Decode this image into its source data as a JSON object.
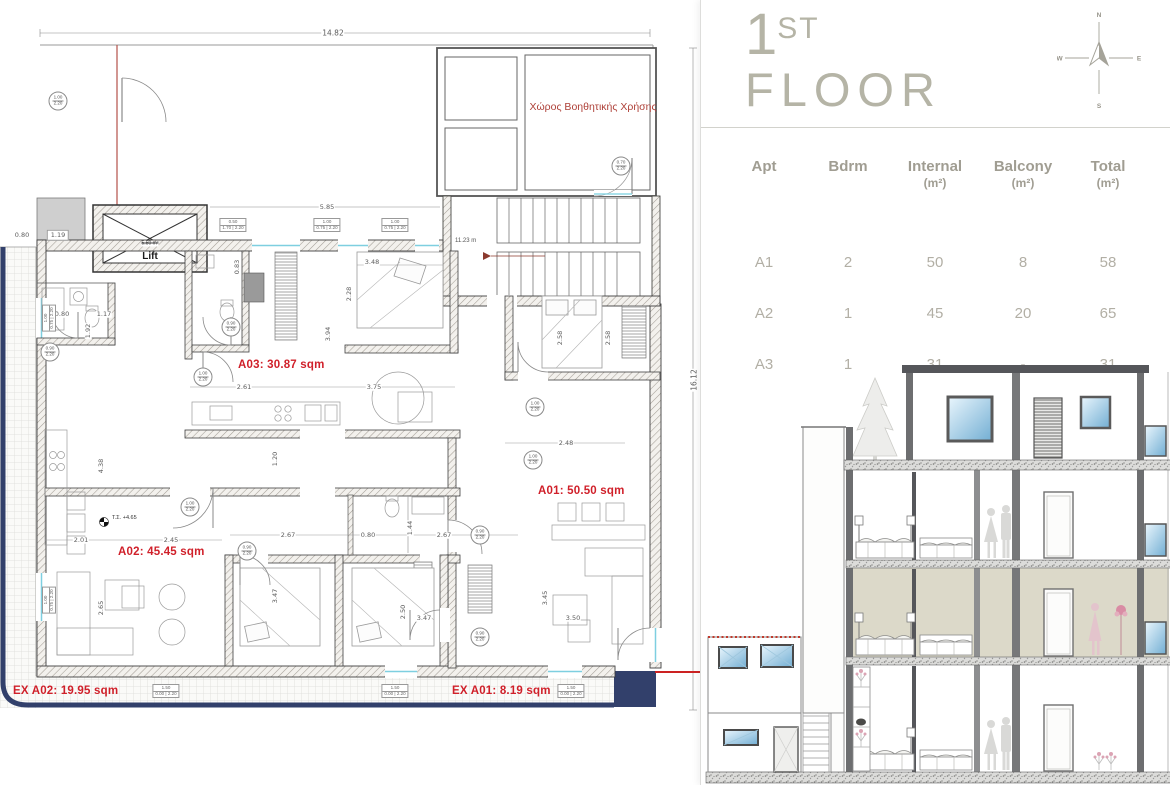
{
  "panel": {
    "title": {
      "number": "1",
      "suffix": "ST",
      "word": "FLOOR"
    },
    "compass": {
      "n": "N",
      "e": "E",
      "s": "S",
      "w": "W"
    },
    "table": {
      "headers": [
        {
          "label": "Apt",
          "unit": ""
        },
        {
          "label": "Bdrm",
          "unit": ""
        },
        {
          "label": "Internal",
          "unit": "(m²)"
        },
        {
          "label": "Balcony",
          "unit": "(m²)"
        },
        {
          "label": "Total",
          "unit": "(m²)"
        }
      ],
      "rows": [
        {
          "apt": "A1",
          "bdrm": "2",
          "internal": "50",
          "balcony": "8",
          "total": "58"
        },
        {
          "apt": "A2",
          "bdrm": "1",
          "internal": "45",
          "balcony": "20",
          "total": "65"
        },
        {
          "apt": "A3",
          "bdrm": "1",
          "internal": "31",
          "balcony": "-",
          "total": "31"
        }
      ]
    }
  },
  "plan": {
    "apartments": {
      "a01": "A01:  50.50 sqm",
      "a02": "A02:  45.45 sqm",
      "a03": "A03:  30.87 sqm",
      "ex_a01": "EX A01:  8.19 sqm",
      "ex_a02": "EX A02:  19.95 sqm"
    },
    "room_labels": {
      "utility": "Χώρος Βοηθητικής Χρήσης",
      "lift": "Lift",
      "lift_area": "5.50 m²",
      "stair_area": "11.23 m",
      "level": "Τ.Σ. +4.65"
    },
    "dims": {
      "overall_w": "14.82",
      "overall_h": "16.12",
      "d585": "5.85",
      "d080a": "0.80",
      "d119": "1.19",
      "d083": "0.83",
      "d348": "3.48",
      "d228": "2.28",
      "d394": "3.94",
      "d261": "2.61",
      "d375": "3.75",
      "d258a": "2.58",
      "d258b": "2.58",
      "d248": "2.48",
      "d080b": "0.80",
      "d117": "1.17",
      "d192": "1.92",
      "d438": "4.38",
      "d201": "2.01",
      "d245": "2.45",
      "d265": "2.65",
      "d120": "1.20",
      "d267a": "2.67",
      "d080c": "0.80",
      "d144": "1.44",
      "d267b": "2.67",
      "d347a": "3.47",
      "d250": "2.50",
      "d347b": "3.47",
      "d345": "3.45",
      "d350": "3.50"
    },
    "door_badges": {
      "b100": {
        "w": "1.00",
        "h": "2.20"
      },
      "b090": {
        "w": "0.90",
        "h": "2.20"
      },
      "b070": {
        "w": "0.70",
        "h": "2.20"
      }
    },
    "window_boxes": {
      "t1": {
        "a": "0.50",
        "b": "1.70 | 2.20"
      },
      "t2": {
        "a": "1.00",
        "b": "0.75 | 2.20"
      },
      "bt": {
        "a": "1.50",
        "b": "0.00 | 2.20"
      }
    }
  }
}
